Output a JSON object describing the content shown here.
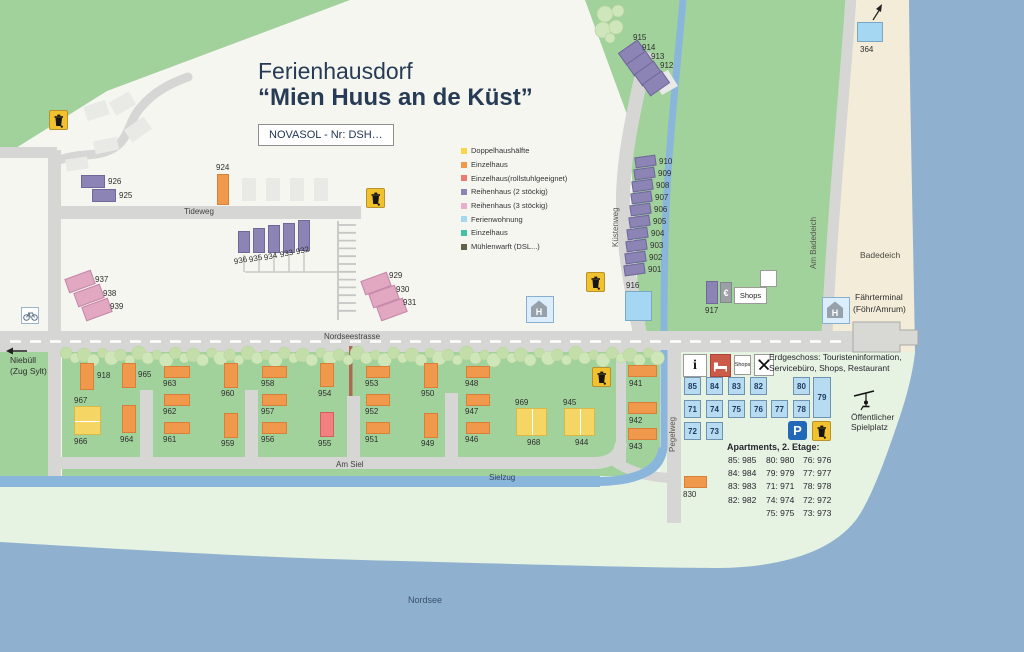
{
  "title": {
    "line1": "Ferienhausdorf",
    "line2": "“Mien Huus an de Küst”"
  },
  "novasol_label": "NOVASOL - Nr: DSH…",
  "colors": {
    "doppelhaus": "#f5d563",
    "einzelhaus": "#f0984c",
    "rollstuhl": "#f28080",
    "reihenhaus2": "#8b84b5",
    "reihenhaus3": "#e2a8c2",
    "ferienwohnung": "#a5d6f2",
    "einzelhaus_gruen": "#45c0a5",
    "muehlenwarft": "#64604c",
    "water": "#8fb0cf",
    "stream": "#8ab6dc",
    "green": "#a2d29c",
    "pale": "#e6f2e2",
    "beach": "#f3ecd9",
    "road": "#d6d6d4",
    "parking_blue": "#2268b8",
    "service_red": "#cc5a48"
  },
  "legend": [
    {
      "label": "Doppelhaushälfte",
      "color": "#f7d64a"
    },
    {
      "label": "Einzelhaus",
      "color": "#f0984c"
    },
    {
      "label": "Einzelhaus(rollstuhlgeeignet)",
      "color": "#f07a72"
    },
    {
      "label": "Reihenhaus (2 stöckig)",
      "color": "#8b84b5"
    },
    {
      "label": "Reihenhaus (3 stöckig)",
      "color": "#e8aecb"
    },
    {
      "label": "Ferienwohnung",
      "color": "#a5d6f2"
    },
    {
      "label": "Einzelhaus",
      "color": "#45c0a5"
    },
    {
      "label": "Mühlenwarft (DSL...)",
      "color": "#64604c"
    }
  ],
  "roads": {
    "tideweg": "Tideweg",
    "nordseestrasse": "Nordseestrasse",
    "am_siel": "Am Siel",
    "sielzug": "Sielzug",
    "kuestenweg": "Küstenweg",
    "am_badedeich": "Am Badedeich",
    "pegelweg": "Pegelweg"
  },
  "labels": {
    "nordsee": "Nordsee",
    "badedeich": "Badedeich",
    "faehrterminal_1": "Fährterminal",
    "faehrterminal_2": "(Föhr/Amrum)",
    "niebuell_1": "Niebüll",
    "niebuell_2": "(Zug Sylt)",
    "spielplatz_1": "Öffentlicher",
    "spielplatz_2": "Spielplatz",
    "shops": "Shops",
    "shops_small": "Shops",
    "euro": "€",
    "info": "i",
    "parking": "P",
    "bus_stop": "H"
  },
  "erdgeschoss": {
    "line1": "Erdgeschoss: Touristeninformation,",
    "line2": "Servicebüro, Shops, Restaurant"
  },
  "apartments": {
    "title": "Apartments, 2. Etage:",
    "grid": [
      {
        "num": "85",
        "x": 684,
        "y": 377,
        "w": 17,
        "h": 18
      },
      {
        "num": "84",
        "x": 706,
        "y": 377,
        "w": 17,
        "h": 18
      },
      {
        "num": "83",
        "x": 728,
        "y": 377,
        "w": 17,
        "h": 18
      },
      {
        "num": "82",
        "x": 750,
        "y": 377,
        "w": 17,
        "h": 18
      },
      {
        "num": "80",
        "x": 793,
        "y": 377,
        "w": 17,
        "h": 18
      },
      {
        "num": "79",
        "x": 813,
        "y": 377,
        "w": 18,
        "h": 41
      },
      {
        "num": "71",
        "x": 684,
        "y": 400,
        "w": 17,
        "h": 18
      },
      {
        "num": "74",
        "x": 706,
        "y": 400,
        "w": 17,
        "h": 18
      },
      {
        "num": "75",
        "x": 728,
        "y": 400,
        "w": 17,
        "h": 18
      },
      {
        "num": "76",
        "x": 750,
        "y": 400,
        "w": 17,
        "h": 18
      },
      {
        "num": "77",
        "x": 771,
        "y": 400,
        "w": 17,
        "h": 18
      },
      {
        "num": "78",
        "x": 793,
        "y": 400,
        "w": 17,
        "h": 18
      },
      {
        "num": "72",
        "x": 684,
        "y": 422,
        "w": 17,
        "h": 18
      },
      {
        "num": "73",
        "x": 706,
        "y": 422,
        "w": 17,
        "h": 18
      }
    ],
    "rows": [
      [
        "85: 985",
        "80: 980",
        "76: 976"
      ],
      [
        "84: 984",
        "79: 979",
        "77: 977"
      ],
      [
        "83: 983",
        "71: 971",
        "78: 978"
      ],
      [
        "82: 982",
        "74: 974",
        "72: 972"
      ],
      [
        "",
        "75: 975",
        "73: 973"
      ]
    ]
  },
  "houses": [
    {
      "id": "915",
      "type": "reihenhaus2",
      "x": 620,
      "y": 45,
      "w": 24,
      "h": 15,
      "rot": -35,
      "lx": 633,
      "ly": 34
    },
    {
      "id": "914",
      "type": "reihenhaus2",
      "x": 628,
      "y": 56,
      "w": 24,
      "h": 15,
      "rot": -35,
      "lx": 642,
      "ly": 44
    },
    {
      "id": "913",
      "type": "reihenhaus2",
      "x": 636,
      "y": 66,
      "w": 24,
      "h": 15,
      "rot": -35,
      "lx": 651,
      "ly": 53
    },
    {
      "id": "912",
      "type": "reihenhaus2",
      "x": 644,
      "y": 76,
      "w": 24,
      "h": 15,
      "rot": -35,
      "lx": 660,
      "ly": 62
    },
    {
      "id": "910",
      "type": "reihenhaus2",
      "x": 635,
      "y": 156,
      "w": 21,
      "h": 11,
      "rot": -8,
      "lx": 659,
      "ly": 158
    },
    {
      "id": "909",
      "type": "reihenhaus2",
      "x": 634,
      "y": 168,
      "w": 21,
      "h": 11,
      "rot": -8,
      "lx": 658,
      "ly": 170
    },
    {
      "id": "908",
      "type": "reihenhaus2",
      "x": 632,
      "y": 180,
      "w": 21,
      "h": 11,
      "rot": -8,
      "lx": 656,
      "ly": 182
    },
    {
      "id": "907",
      "type": "reihenhaus2",
      "x": 631,
      "y": 192,
      "w": 21,
      "h": 11,
      "rot": -8,
      "lx": 655,
      "ly": 194
    },
    {
      "id": "906",
      "type": "reihenhaus2",
      "x": 630,
      "y": 204,
      "w": 21,
      "h": 11,
      "rot": -8,
      "lx": 654,
      "ly": 206
    },
    {
      "id": "905",
      "type": "reihenhaus2",
      "x": 629,
      "y": 216,
      "w": 21,
      "h": 11,
      "rot": -8,
      "lx": 653,
      "ly": 218
    },
    {
      "id": "904",
      "type": "reihenhaus2",
      "x": 627,
      "y": 228,
      "w": 21,
      "h": 11,
      "rot": -8,
      "lx": 651,
      "ly": 230
    },
    {
      "id": "903",
      "type": "reihenhaus2",
      "x": 626,
      "y": 240,
      "w": 21,
      "h": 11,
      "rot": -8,
      "lx": 650,
      "ly": 242
    },
    {
      "id": "902",
      "type": "reihenhaus2",
      "x": 625,
      "y": 252,
      "w": 21,
      "h": 11,
      "rot": -8,
      "lx": 649,
      "ly": 254
    },
    {
      "id": "901",
      "type": "reihenhaus2",
      "x": 624,
      "y": 264,
      "w": 21,
      "h": 11,
      "rot": -8,
      "lx": 648,
      "ly": 266
    },
    {
      "id": "916",
      "type": "ferienwohnung",
      "x": 625,
      "y": 291,
      "w": 27,
      "h": 30,
      "rot": 0,
      "lx": 626,
      "ly": 282
    },
    {
      "id": "364",
      "type": "ferienwohnung",
      "x": 857,
      "y": 22,
      "w": 26,
      "h": 20,
      "rot": 0,
      "lx": 860,
      "ly": 46
    },
    {
      "id": "917",
      "type": "reihenhaus2",
      "x": 706,
      "y": 281,
      "w": 12,
      "h": 23,
      "rot": 0,
      "lx": 705,
      "ly": 307
    },
    {
      "id": "926",
      "type": "reihenhaus2",
      "x": 81,
      "y": 175,
      "w": 24,
      "h": 13,
      "rot": 0,
      "lx": 108,
      "ly": 178
    },
    {
      "id": "925",
      "type": "reihenhaus2",
      "x": 92,
      "y": 189,
      "w": 24,
      "h": 13,
      "rot": 0,
      "lx": 119,
      "ly": 192
    },
    {
      "id": "924",
      "type": "einzelhaus",
      "x": 217,
      "y": 174,
      "w": 12,
      "h": 31,
      "rot": 0,
      "lx": 216,
      "ly": 164
    },
    {
      "id": "936",
      "type": "reihenhaus2",
      "x": 238,
      "y": 231,
      "w": 12,
      "h": 22,
      "rot": 0,
      "lx": 234,
      "ly": 257,
      "lrot": -12
    },
    {
      "id": "935",
      "type": "reihenhaus2",
      "x": 253,
      "y": 228,
      "w": 12,
      "h": 25,
      "rot": 0,
      "lx": 249,
      "ly": 255,
      "lrot": -12
    },
    {
      "id": "934",
      "type": "reihenhaus2",
      "x": 268,
      "y": 225,
      "w": 12,
      "h": 28,
      "rot": 0,
      "lx": 264,
      "ly": 253,
      "lrot": -12
    },
    {
      "id": "933",
      "type": "reihenhaus2",
      "x": 283,
      "y": 223,
      "w": 12,
      "h": 30,
      "rot": 0,
      "lx": 280,
      "ly": 250,
      "lrot": -12
    },
    {
      "id": "932",
      "type": "reihenhaus2",
      "x": 298,
      "y": 220,
      "w": 12,
      "h": 31,
      "rot": 0,
      "lx": 296,
      "ly": 247,
      "lrot": -12
    },
    {
      "id": "937",
      "type": "reihenhaus3",
      "x": 66,
      "y": 274,
      "w": 28,
      "h": 15,
      "rot": -20,
      "lx": 95,
      "ly": 276
    },
    {
      "id": "938",
      "type": "reihenhaus3",
      "x": 75,
      "y": 288,
      "w": 28,
      "h": 15,
      "rot": -20,
      "lx": 103,
      "ly": 290
    },
    {
      "id": "939",
      "type": "reihenhaus3",
      "x": 83,
      "y": 302,
      "w": 28,
      "h": 15,
      "rot": -20,
      "lx": 110,
      "ly": 303
    },
    {
      "id": "929",
      "type": "reihenhaus3",
      "x": 362,
      "y": 276,
      "w": 28,
      "h": 15,
      "rot": -20,
      "lx": 389,
      "ly": 272
    },
    {
      "id": "930",
      "type": "reihenhaus3",
      "x": 370,
      "y": 289,
      "w": 28,
      "h": 15,
      "rot": -20,
      "lx": 396,
      "ly": 286
    },
    {
      "id": "931",
      "type": "reihenhaus3",
      "x": 378,
      "y": 302,
      "w": 28,
      "h": 15,
      "rot": -20,
      "lx": 403,
      "ly": 299
    },
    {
      "id": "918",
      "type": "einzelhaus",
      "x": 80,
      "y": 363,
      "w": 14,
      "h": 27,
      "rot": 0,
      "lx": 97,
      "ly": 372
    },
    {
      "id": "965",
      "type": "einzelhaus",
      "x": 122,
      "y": 363,
      "w": 14,
      "h": 25,
      "rot": 0,
      "lx": 138,
      "ly": 371
    },
    {
      "id": "964",
      "type": "einzelhaus",
      "x": 122,
      "y": 405,
      "w": 14,
      "h": 28,
      "rot": 0,
      "lx": 120,
      "ly": 436
    },
    {
      "id": "963",
      "type": "einzelhaus",
      "x": 164,
      "y": 366,
      "w": 26,
      "h": 12,
      "rot": 0,
      "lx": 163,
      "ly": 380
    },
    {
      "id": "962",
      "type": "einzelhaus",
      "x": 164,
      "y": 394,
      "w": 26,
      "h": 12,
      "rot": 0,
      "lx": 163,
      "ly": 408
    },
    {
      "id": "961",
      "type": "einzelhaus",
      "x": 164,
      "y": 422,
      "w": 26,
      "h": 12,
      "rot": 0,
      "lx": 163,
      "ly": 436
    },
    {
      "id": "960",
      "type": "einzelhaus",
      "x": 224,
      "y": 363,
      "w": 14,
      "h": 25,
      "rot": 0,
      "lx": 221,
      "ly": 390
    },
    {
      "id": "959",
      "type": "einzelhaus",
      "x": 224,
      "y": 413,
      "w": 14,
      "h": 25,
      "rot": 0,
      "lx": 221,
      "ly": 440
    },
    {
      "id": "958",
      "type": "einzelhaus",
      "x": 262,
      "y": 366,
      "w": 25,
      "h": 12,
      "rot": 0,
      "lx": 261,
      "ly": 380
    },
    {
      "id": "957",
      "type": "einzelhaus",
      "x": 262,
      "y": 394,
      "w": 25,
      "h": 12,
      "rot": 0,
      "lx": 261,
      "ly": 408
    },
    {
      "id": "956",
      "type": "einzelhaus",
      "x": 262,
      "y": 422,
      "w": 25,
      "h": 12,
      "rot": 0,
      "lx": 261,
      "ly": 436
    },
    {
      "id": "954",
      "type": "einzelhaus",
      "x": 320,
      "y": 363,
      "w": 14,
      "h": 24,
      "rot": 0,
      "lx": 318,
      "ly": 390
    },
    {
      "id": "955",
      "type": "rollstuhl",
      "x": 320,
      "y": 412,
      "w": 14,
      "h": 25,
      "rot": 0,
      "lx": 318,
      "ly": 440
    },
    {
      "id": "953",
      "type": "einzelhaus",
      "x": 366,
      "y": 366,
      "w": 24,
      "h": 12,
      "rot": 0,
      "lx": 365,
      "ly": 380
    },
    {
      "id": "952",
      "type": "einzelhaus",
      "x": 366,
      "y": 394,
      "w": 24,
      "h": 12,
      "rot": 0,
      "lx": 365,
      "ly": 408
    },
    {
      "id": "951",
      "type": "einzelhaus",
      "x": 366,
      "y": 422,
      "w": 24,
      "h": 12,
      "rot": 0,
      "lx": 365,
      "ly": 436
    },
    {
      "id": "950",
      "type": "einzelhaus",
      "x": 424,
      "y": 363,
      "w": 14,
      "h": 25,
      "rot": 0,
      "lx": 421,
      "ly": 390
    },
    {
      "id": "949",
      "type": "einzelhaus",
      "x": 424,
      "y": 413,
      "w": 14,
      "h": 25,
      "rot": 0,
      "lx": 421,
      "ly": 440
    },
    {
      "id": "948",
      "type": "einzelhaus",
      "x": 466,
      "y": 366,
      "w": 24,
      "h": 12,
      "rot": 0,
      "lx": 465,
      "ly": 380
    },
    {
      "id": "947",
      "type": "einzelhaus",
      "x": 466,
      "y": 394,
      "w": 24,
      "h": 12,
      "rot": 0,
      "lx": 465,
      "ly": 408
    },
    {
      "id": "946",
      "type": "einzelhaus",
      "x": 466,
      "y": 422,
      "w": 24,
      "h": 12,
      "rot": 0,
      "lx": 465,
      "ly": 436
    },
    {
      "id": "941",
      "type": "einzelhaus",
      "x": 628,
      "y": 365,
      "w": 29,
      "h": 12,
      "rot": 0,
      "lx": 629,
      "ly": 380
    },
    {
      "id": "942",
      "type": "einzelhaus",
      "x": 628,
      "y": 402,
      "w": 29,
      "h": 12,
      "rot": 0,
      "lx": 629,
      "ly": 417
    },
    {
      "id": "943",
      "type": "einzelhaus",
      "x": 628,
      "y": 428,
      "w": 29,
      "h": 12,
      "rot": 0,
      "lx": 629,
      "ly": 443
    },
    {
      "id": "830",
      "type": "einzelhaus",
      "x": 684,
      "y": 476,
      "w": 23,
      "h": 12,
      "rot": 0,
      "lx": 683,
      "ly": 491
    }
  ],
  "double_houses": [
    {
      "ids": [
        "967",
        "966"
      ],
      "x": 74,
      "y": 406,
      "w": 27,
      "h": 29,
      "split": "h",
      "l1x": 74,
      "l1y": 397,
      "l2x": 74,
      "l2y": 438
    },
    {
      "ids": [
        "969",
        "968"
      ],
      "x": 516,
      "y": 408,
      "w": 31,
      "h": 28,
      "split": "v",
      "l1x": 515,
      "l1y": 399,
      "l2x": 527,
      "l2y": 439
    },
    {
      "ids": [
        "945",
        "944"
      ],
      "x": 564,
      "y": 408,
      "w": 31,
      "h": 28,
      "split": "v",
      "l1x": 563,
      "l1y": 399,
      "l2x": 575,
      "l2y": 439
    }
  ],
  "garages": [
    {
      "x": 85,
      "y": 103,
      "w": 23,
      "h": 15,
      "rot": -18
    },
    {
      "x": 111,
      "y": 96,
      "w": 23,
      "h": 15,
      "rot": -30
    },
    {
      "x": 126,
      "y": 122,
      "w": 24,
      "h": 15,
      "rot": -35
    },
    {
      "x": 94,
      "y": 139,
      "w": 24,
      "h": 13,
      "rot": -12
    },
    {
      "x": 66,
      "y": 158,
      "w": 22,
      "h": 12,
      "rot": -8
    },
    {
      "x": 242,
      "y": 178,
      "w": 14,
      "h": 23,
      "rot": 0
    },
    {
      "x": 266,
      "y": 178,
      "w": 14,
      "h": 23,
      "rot": 0
    },
    {
      "x": 290,
      "y": 178,
      "w": 14,
      "h": 23,
      "rot": 0
    },
    {
      "x": 314,
      "y": 178,
      "w": 14,
      "h": 23,
      "rot": 0
    }
  ],
  "trash_positions": [
    [
      49,
      110
    ],
    [
      366,
      188
    ],
    [
      586,
      272
    ],
    [
      592,
      367
    ],
    [
      812,
      421
    ]
  ],
  "bus_stops": [
    [
      526,
      296
    ],
    [
      822,
      297
    ]
  ]
}
